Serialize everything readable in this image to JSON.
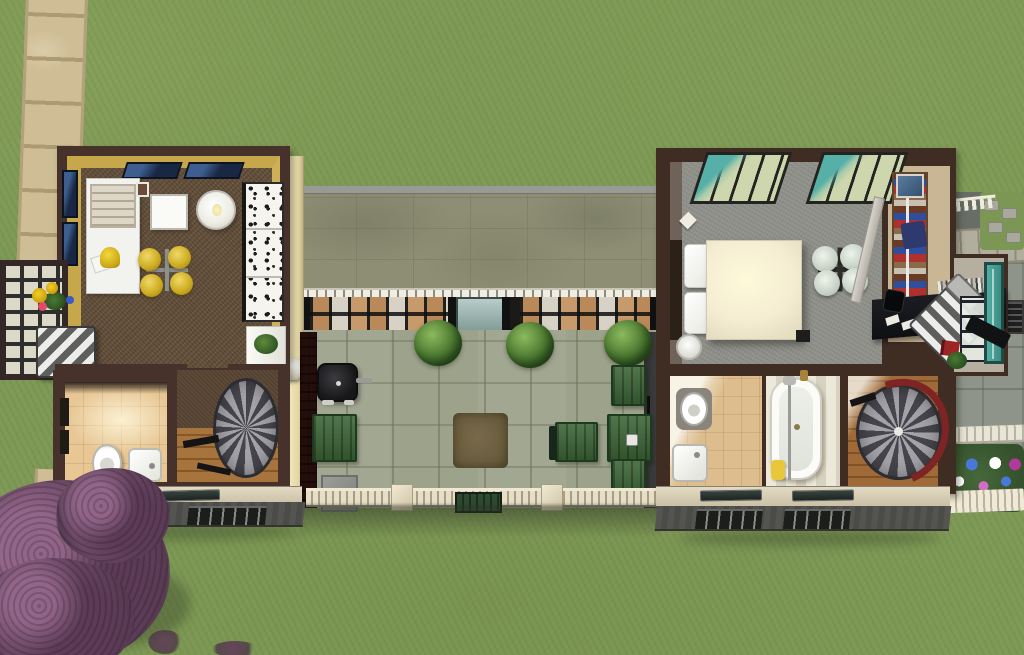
{
  "meta": {
    "title": "Aerial overhead view of a modern house lot in a life-simulation game",
    "width_px": 1024,
    "height_px": 655,
    "view": "top-down"
  },
  "palette": {
    "grass": "#7e9955",
    "path_sandstone": "#cfbd95",
    "roof_stone": "#8d8e74",
    "courtyard_paving": "#9da28b",
    "wall_trim_brown": "#46322a",
    "left_wing_wall_yellow": "#c7a74c",
    "left_wing_floor_brown": "#63503c",
    "bedroom_carpet_gray": "#90908a",
    "bathroom_tile_tan": "#ddbd8d",
    "accent_teal": "#4aa298",
    "fence_cream": "#e6dec6",
    "garden_green": "#3d6637",
    "tree_purple": "#6d4a66",
    "stair_red": "#7e2424"
  },
  "regions": {
    "lawn": {
      "label": "Grass lawn"
    },
    "path": {
      "label": "Sandstone tile path"
    },
    "left_wing": {
      "label": "Left wing - kitchen, dining and bathroom",
      "objects": [
        {
          "name": "kitchen-counter"
        },
        {
          "name": "stove"
        },
        {
          "name": "countertop-mixer"
        },
        {
          "name": "square-dining-table"
        },
        {
          "name": "round-dining-table"
        },
        {
          "name": "yellow-ceiling-lamp"
        },
        {
          "name": "patterned-loveseat"
        },
        {
          "name": "skylight-window",
          "count": 2
        },
        {
          "name": "wall-window",
          "count": 2
        },
        {
          "name": "sunroom-bay-window"
        },
        {
          "name": "sunflower-bouquet"
        },
        {
          "name": "striped-armchair"
        },
        {
          "name": "toilet"
        },
        {
          "name": "bathroom-sink"
        },
        {
          "name": "white-dresser-with-plant"
        },
        {
          "name": "spiral-staircase"
        },
        {
          "name": "wood-floor-landing"
        }
      ]
    },
    "courtyard": {
      "label": "Covered patio courtyard",
      "objects": [
        {
          "name": "flat-stone-roof"
        },
        {
          "name": "dentil-beam"
        },
        {
          "name": "glass-window-wall"
        },
        {
          "name": "patio-door"
        },
        {
          "name": "potted-shrub",
          "count": 3
        },
        {
          "name": "bbq-grill"
        },
        {
          "name": "green-deck-mat"
        },
        {
          "name": "picnic-chair-table"
        },
        {
          "name": "picnic-table"
        },
        {
          "name": "garden-bench",
          "count": 2
        },
        {
          "name": "dry-grass-patch"
        },
        {
          "name": "stone-planter"
        },
        {
          "name": "picket-fence"
        },
        {
          "name": "fence-post",
          "count": 2
        },
        {
          "name": "garden-gate"
        },
        {
          "name": "wall-lantern"
        },
        {
          "name": "brick-wall"
        },
        {
          "name": "slate-wall"
        }
      ]
    },
    "right_wing": {
      "label": "Right wing - bedroom, office and bathrooms",
      "objects": [
        {
          "name": "double-bed"
        },
        {
          "name": "bed-pillow",
          "count": 2
        },
        {
          "name": "frosted-ceiling-lamp"
        },
        {
          "name": "teal-skylight-window",
          "count": 2
        },
        {
          "name": "round-bedside-table"
        },
        {
          "name": "wall-sconce"
        },
        {
          "name": "glass-partition"
        },
        {
          "name": "bookshelf"
        },
        {
          "name": "wall-art"
        },
        {
          "name": "computer-desk"
        },
        {
          "name": "desk-books"
        },
        {
          "name": "striped-lounge-chair"
        },
        {
          "name": "teal-door"
        },
        {
          "name": "red-book"
        },
        {
          "name": "potted-plant"
        },
        {
          "name": "toilet"
        },
        {
          "name": "bathroom-sink"
        },
        {
          "name": "bathtub-with-shower"
        },
        {
          "name": "yellow-towel"
        },
        {
          "name": "red-spiral-staircase"
        },
        {
          "name": "wood-floor-landing"
        }
      ]
    },
    "side_yard": {
      "label": "East side yard",
      "objects": [
        {
          "name": "stone-pavement"
        },
        {
          "name": "paver-band"
        },
        {
          "name": "stepping-stones"
        },
        {
          "name": "picket-fence-fragment"
        },
        {
          "name": "drain-grate"
        },
        {
          "name": "white-rail"
        },
        {
          "name": "flower-bed"
        },
        {
          "name": "flower-bed-picket-border"
        }
      ]
    },
    "tree": {
      "label": "Purple-leaf plum tree"
    }
  }
}
